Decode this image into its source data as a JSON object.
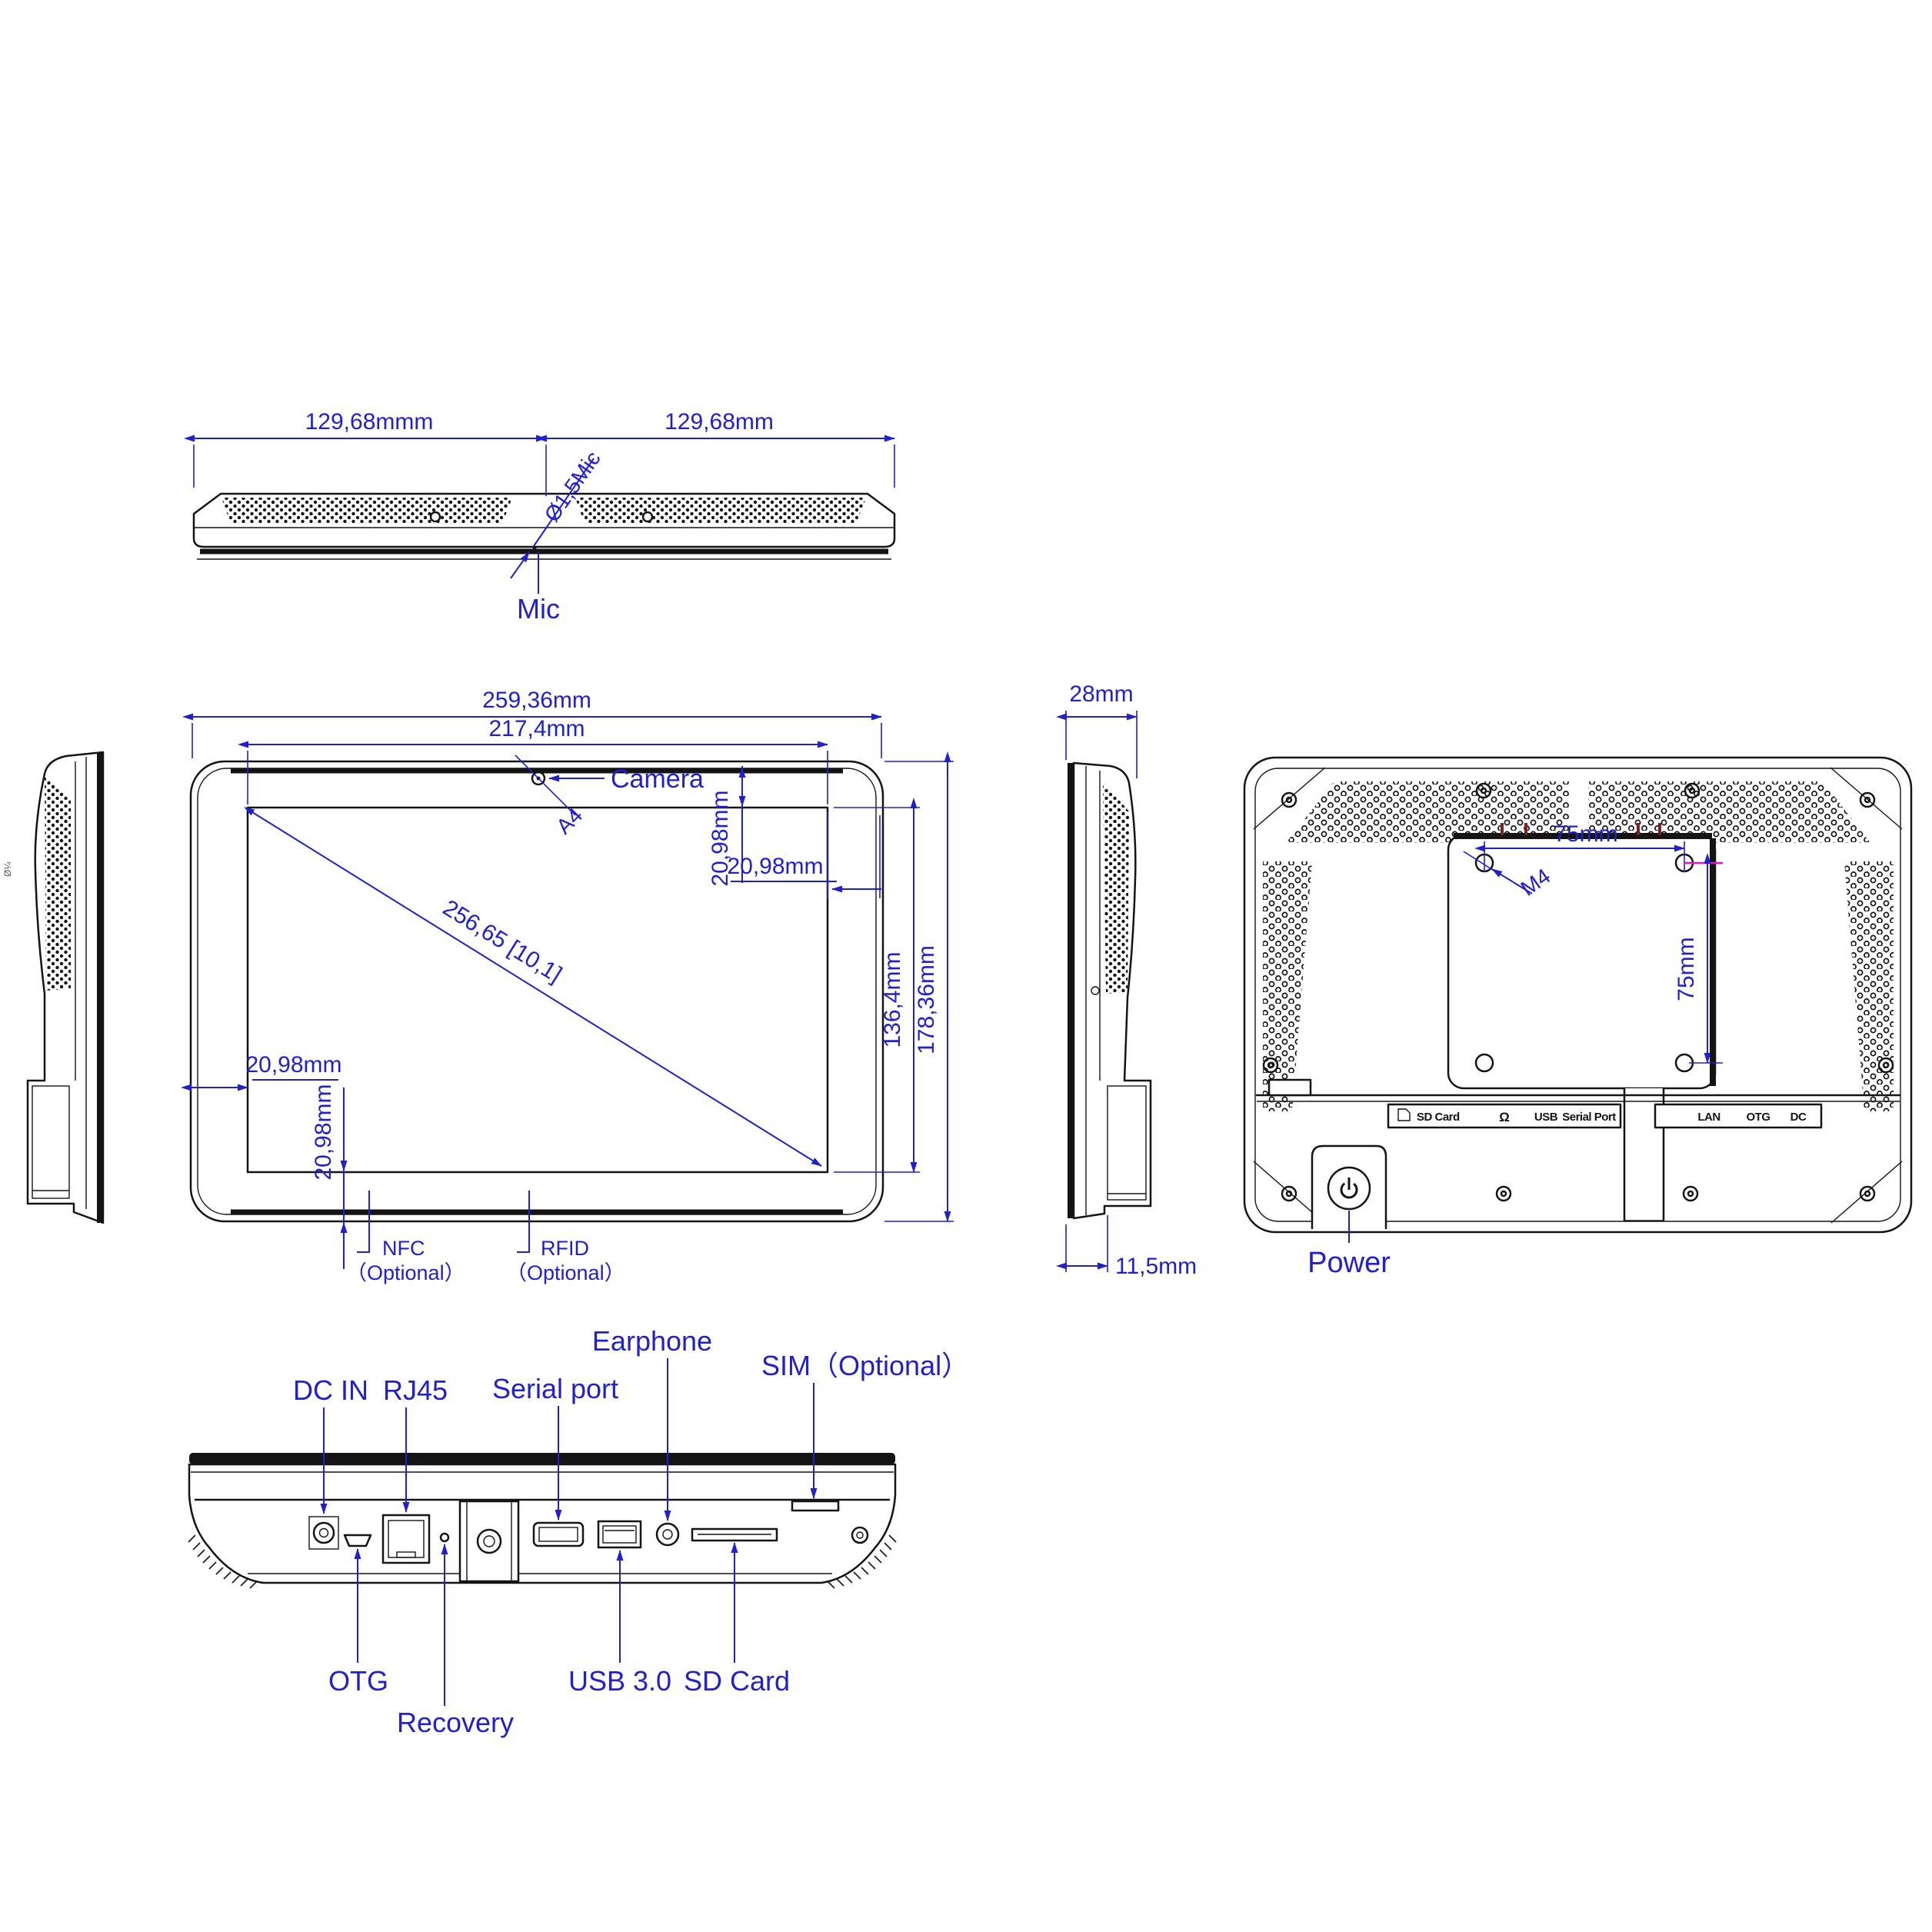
{
  "top_view": {
    "dim_left": "129,68mmm",
    "dim_right": "129,68mm",
    "mic_callout": "Ø1,5Mic",
    "mic_label": "Mic"
  },
  "front_view": {
    "overall_width": "259,36mm",
    "screen_width": "217,4mm",
    "screen_height": "136,4mm",
    "overall_height": "178,36mm",
    "diagonal": "256,65 [10,1]",
    "camera_label": "Camera",
    "camera_section": "A4",
    "bezel_top": "20,98mm",
    "bezel_right": "20,98mm",
    "bezel_left": "20,98mm",
    "bezel_bottom": "20,98mm",
    "nfc": "NFC",
    "nfc_note": "（Optional）",
    "rfid": "RFID",
    "rfid_note": "（Optional）"
  },
  "side_view": {
    "depth": "28mm",
    "bracket_offset": "11,5mm"
  },
  "back_view": {
    "vesa_width": "75mm",
    "vesa_height": "75mm",
    "screw_spec": "M4",
    "power_label": "Power",
    "ports_left": {
      "sd": "SD Card",
      "headphone_icon": "Ω",
      "usb": "USB",
      "serial": "Serial Port"
    },
    "ports_right": {
      "lan": "LAN",
      "otg": "OTG",
      "dc": "DC"
    }
  },
  "bottom_view": {
    "dc_in": "DC IN",
    "rj45": "RJ45",
    "serial_port": "Serial port",
    "earphone": "Earphone",
    "sim": "SIM（Optional）",
    "otg": "OTG",
    "recovery": "Recovery",
    "usb": "USB 3.0",
    "sd_card": "SD Card"
  },
  "misc": {
    "margin_mark": "Ø¼"
  }
}
